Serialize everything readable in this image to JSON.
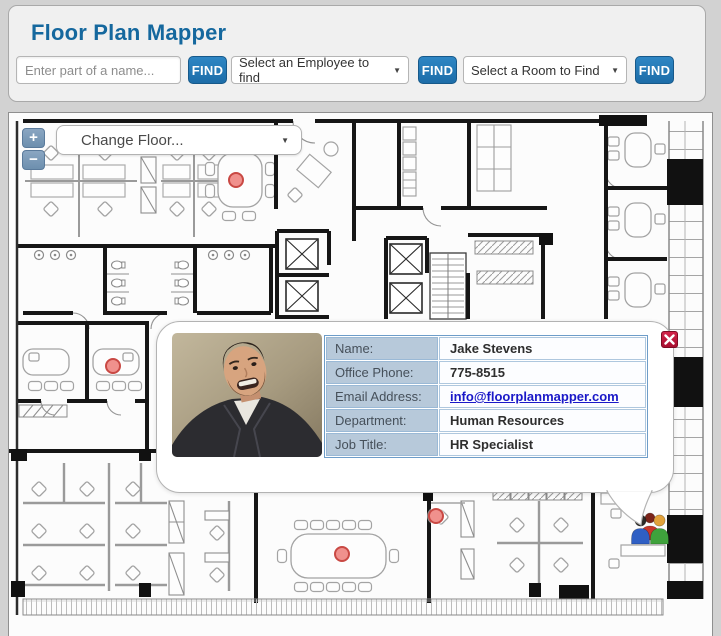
{
  "header": {
    "title": "Floor Plan Mapper",
    "name_input_placeholder": "Enter part of a name...",
    "find_button_label": "FIND",
    "employee_select_value": "Select an Employee to find",
    "room_select_value": "Select a Room to Find",
    "dropdown_arrow": "▼"
  },
  "map": {
    "zoom_in_label": "+",
    "zoom_out_label": "−",
    "floor_select_value": "Change Floor...",
    "markers": [
      {
        "name": "conference-room-top",
        "x": 227,
        "y": 67
      },
      {
        "name": "office-left",
        "x": 104,
        "y": 253
      },
      {
        "name": "desk-center-bottom",
        "x": 427,
        "y": 403
      },
      {
        "name": "conference-room-bottom",
        "x": 333,
        "y": 441
      }
    ],
    "people_icon": {
      "x": 621,
      "y": 393
    }
  },
  "popup": {
    "fields": [
      {
        "label": "Name:",
        "value": "Jake Stevens"
      },
      {
        "label": "Office Phone:",
        "value": "775-8515"
      },
      {
        "label": "Email Address:",
        "value": "info@floorplanmapper.com"
      },
      {
        "label": "Department:",
        "value": "Human Resources"
      },
      {
        "label": "Job Title:",
        "value": "HR Specialist"
      }
    ]
  },
  "colors": {
    "title_blue": "#15689e",
    "button_blue": "#2076b4",
    "table_label_bg": "#b7c9da",
    "table_border": "#6e9dc9",
    "link_blue": "#1a18c8",
    "close_red": "#b5173a",
    "marker_fill": "#f0918d",
    "marker_stroke": "#c94944",
    "zoom_button_blue": "#6d8fae"
  }
}
